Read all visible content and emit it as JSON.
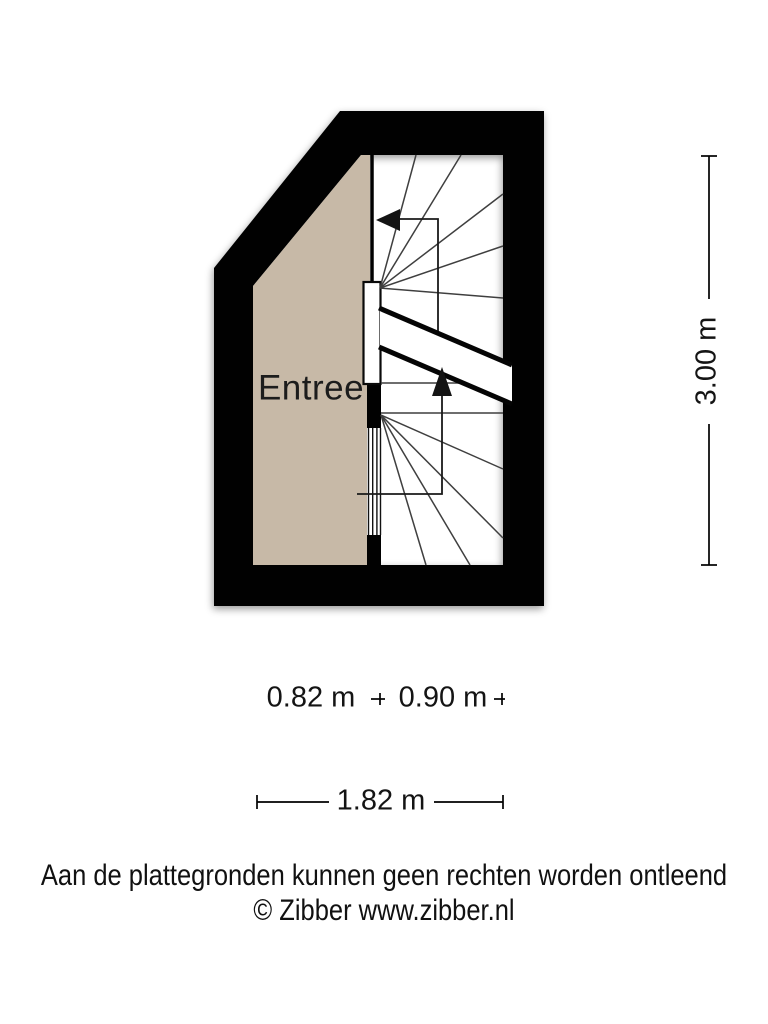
{
  "floorplan": {
    "room_label": "Entree",
    "wall_color": "#010101",
    "floor_color": "#c7b9a7",
    "stair_line_color": "#3f3f3f"
  },
  "dimensions": {
    "height": "3.00 m",
    "width_left": "0.82 m",
    "width_right": "0.90 m",
    "width_total": "1.82 m"
  },
  "footer": {
    "disclaimer": "Aan de plattegronden kunnen geen rechten worden ontleend",
    "copyright": "© Zibber www.zibber.nl"
  }
}
